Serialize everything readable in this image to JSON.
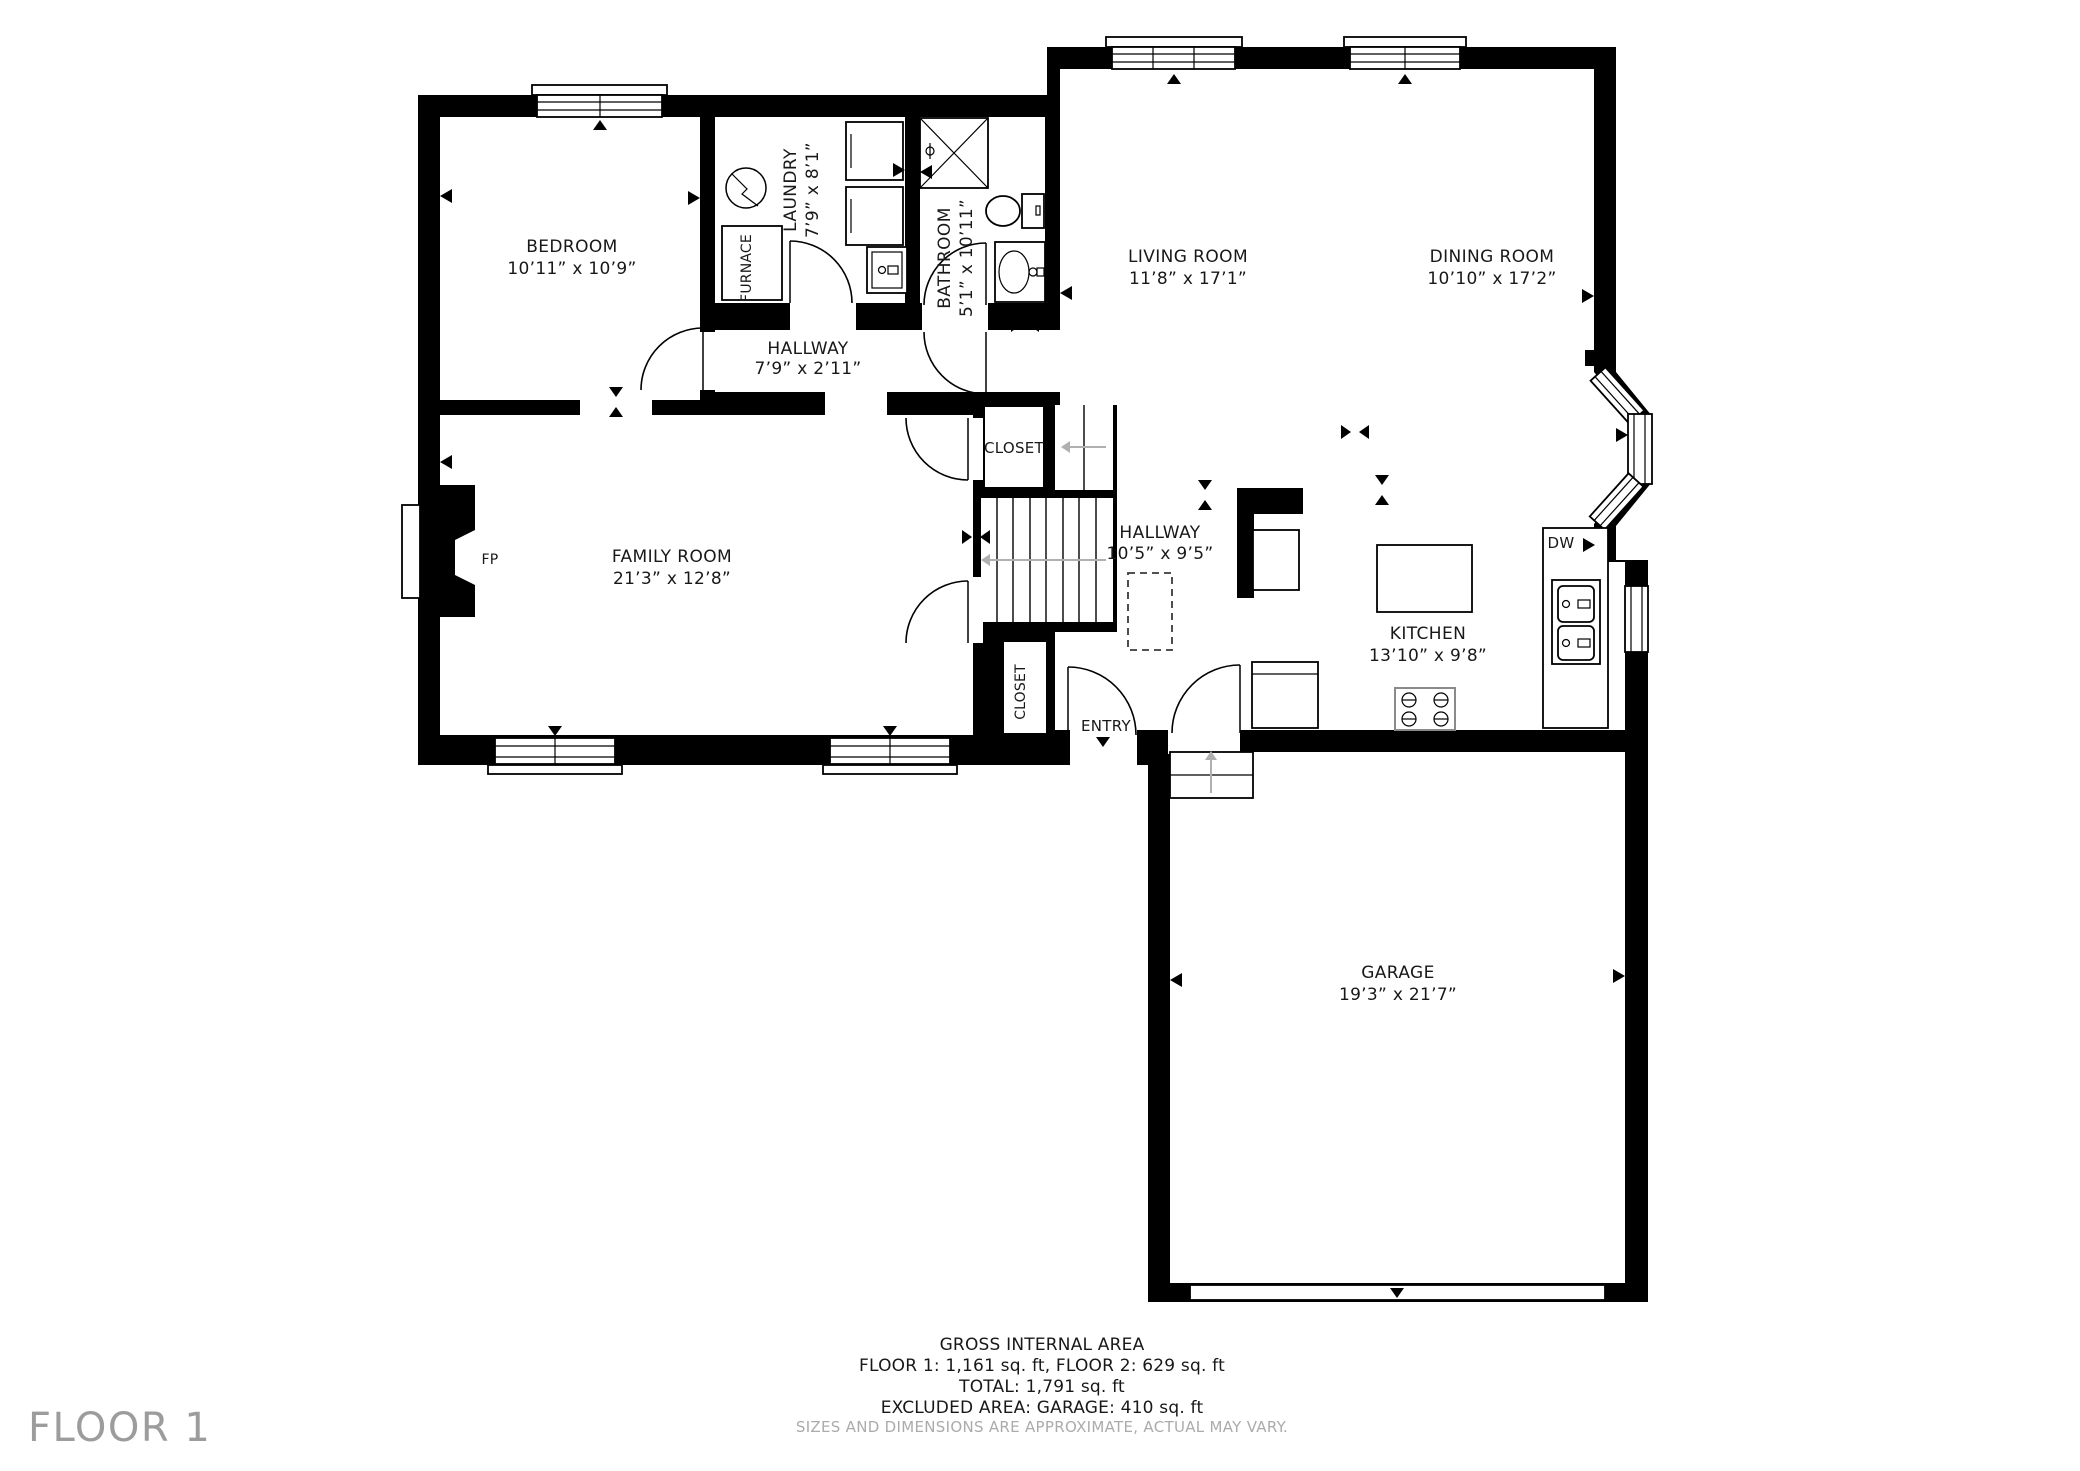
{
  "floor_label": "FLOOR 1",
  "rooms": {
    "bedroom": {
      "name": "BEDROOM",
      "dims": "10’11” x 10’9”"
    },
    "laundry": {
      "name": "LAUNDRY",
      "dims": "7’9” x 8’1”"
    },
    "bathroom": {
      "name": "BATHROOM",
      "dims": "5’1” x 10’11”"
    },
    "hallway_small": {
      "name": "HALLWAY",
      "dims": "7’9” x 2’11”"
    },
    "family": {
      "name": "FAMILY ROOM",
      "dims": "21’3” x 12’8”"
    },
    "hallway_main": {
      "name": "HALLWAY",
      "dims": "10’5” x 9’5”"
    },
    "kitchen": {
      "name": "KITCHEN",
      "dims": "13’10” x 9’8”"
    },
    "living": {
      "name": "LIVING ROOM",
      "dims": "11’8” x 17’1”"
    },
    "dining": {
      "name": "DINING ROOM",
      "dims": "10’10” x 17’2”"
    },
    "garage": {
      "name": "GARAGE",
      "dims": "19’3” x 21’7”"
    }
  },
  "labels": {
    "furnace": "FURNACE",
    "fp": "FP",
    "dw": "DW",
    "closet_upper": "CLOSET",
    "closet_lower": "CLOSET",
    "entry": "ENTRY"
  },
  "footer": {
    "title": "GROSS INTERNAL AREA",
    "floors": "FLOOR 1: 1,161 sq. ft, FLOOR 2: 629 sq. ft",
    "total": "TOTAL: 1,791 sq. ft",
    "excluded": "EXCLUDED AREA: GARAGE: 410 sq. ft",
    "disclaimer": "SIZES AND DIMENSIONS ARE APPROXIMATE, ACTUAL MAY VARY."
  },
  "colors": {
    "wall": "#000000",
    "muted": "#9c9c9c"
  }
}
